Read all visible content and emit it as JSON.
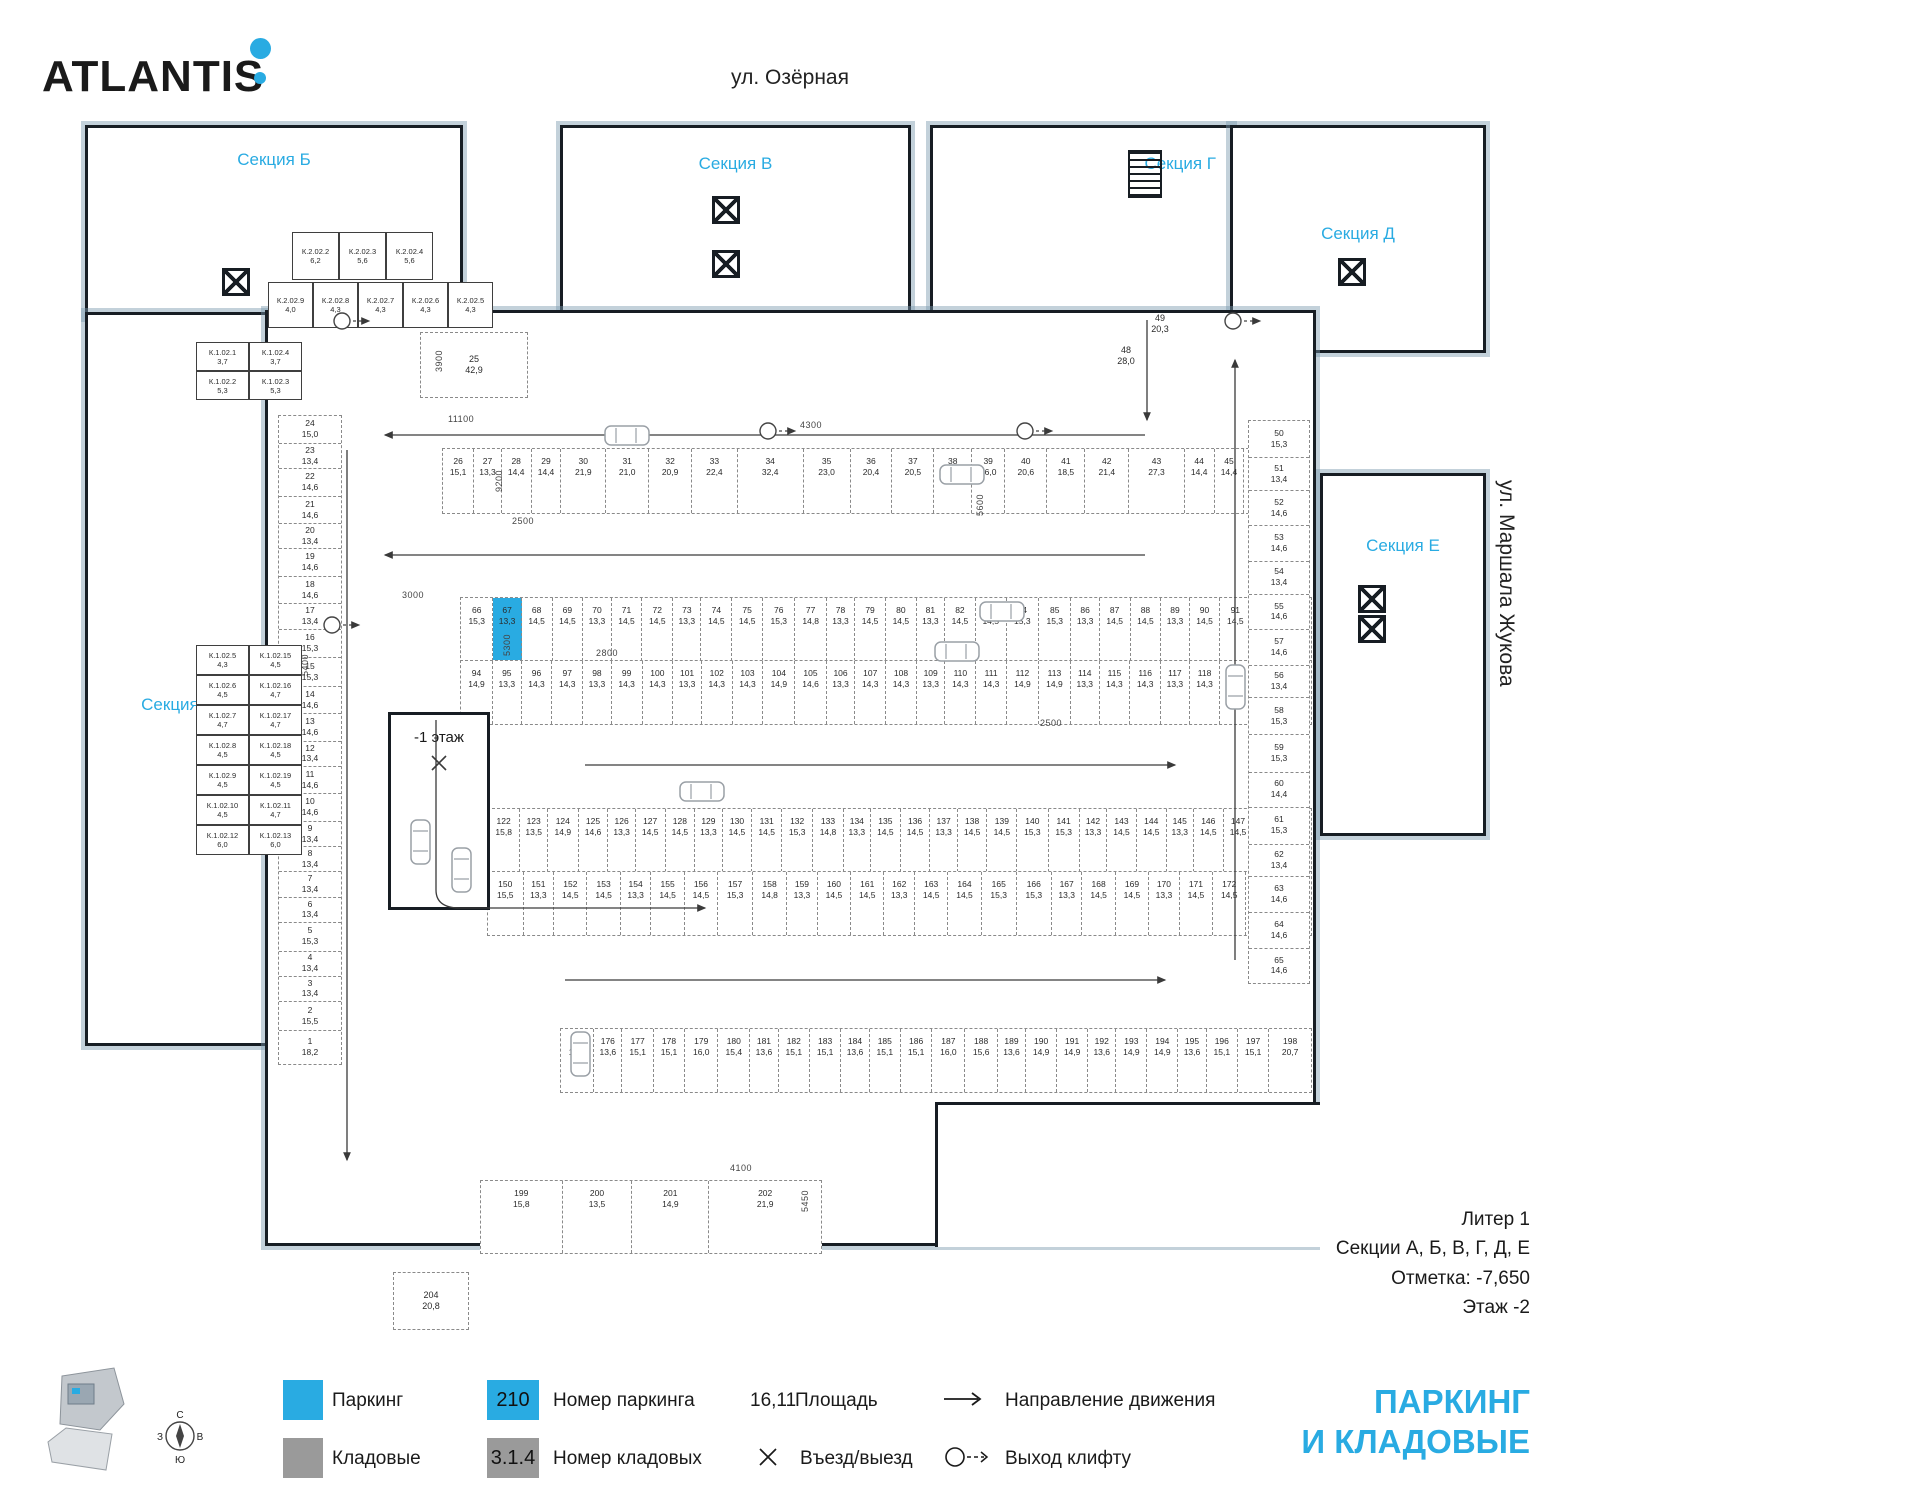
{
  "brand": {
    "logo_text": "ATLANTIS"
  },
  "streets": {
    "top": "ул. Озёрная",
    "right": "ул. Маршала Жукова"
  },
  "sections": {
    "a": "Секция А",
    "b": "Секция Б",
    "v": "Секция В",
    "g": "Секция Г",
    "d": "Секция Д",
    "e": "Секция Е"
  },
  "title_block": {
    "line1": "Литер 1",
    "line2": "Секции А, Б, В, Г, Д, Е",
    "line3": "Отметка:  -7,650",
    "line4": "Этаж  -2"
  },
  "poster_title": {
    "line1": "ПАРКИНГ",
    "line2": "И КЛАДОВЫЕ"
  },
  "legend": {
    "parking_label": "Паркинг",
    "parking_number_box": "210",
    "parking_number_label": "Номер паркинга",
    "area_value": "16,11",
    "area_label": "Площадь",
    "direction_label": "Направление движения",
    "storage_label": "Кладовые",
    "storage_number_box": "3.1.4",
    "storage_number_label": "Номер кладовых",
    "entry_label": "Въезд/выезд",
    "lift_label": "Выход клифту"
  },
  "colors": {
    "accent": "#29abe2",
    "storage_gray": "#9a9a9a",
    "wall": "#171d23",
    "perimeter": "#7a99ac"
  },
  "ramp": {
    "label": "-1 этаж"
  },
  "compass": {
    "n": "С",
    "s": "Ю",
    "e": "В",
    "w": "З"
  },
  "highlight_spot": "67",
  "rows": {
    "top": [
      [
        "26",
        "15,1"
      ],
      [
        "27",
        "13,3"
      ],
      [
        "28",
        "14,4"
      ],
      [
        "29",
        "14,4"
      ],
      [
        "30",
        "21,9"
      ],
      [
        "31",
        "21,0"
      ],
      [
        "32",
        "20,9"
      ],
      [
        "33",
        "22,4"
      ],
      [
        "34",
        "32,4"
      ],
      [
        "35",
        "23,0"
      ],
      [
        "36",
        "20,4"
      ],
      [
        "37",
        "20,5"
      ],
      [
        "38",
        "18,4"
      ],
      [
        "39",
        "16,0"
      ],
      [
        "40",
        "20,6"
      ],
      [
        "41",
        "18,5"
      ],
      [
        "42",
        "21,4"
      ],
      [
        "43",
        "27,3"
      ],
      [
        "44",
        "14,4"
      ],
      [
        "45",
        "14,4"
      ],
      [
        "46",
        "14,4"
      ],
      [
        "47",
        "14,4"
      ]
    ],
    "mid1": [
      [
        "66",
        "15,3"
      ],
      [
        "67",
        "13,3"
      ],
      [
        "68",
        "14,5"
      ],
      [
        "69",
        "14,5"
      ],
      [
        "70",
        "13,3"
      ],
      [
        "71",
        "14,5"
      ],
      [
        "72",
        "14,5"
      ],
      [
        "73",
        "13,3"
      ],
      [
        "74",
        "14,5"
      ],
      [
        "75",
        "14,5"
      ],
      [
        "76",
        "15,3"
      ],
      [
        "77",
        "14,8"
      ],
      [
        "78",
        "13,3"
      ],
      [
        "79",
        "14,5"
      ],
      [
        "80",
        "14,5"
      ],
      [
        "81",
        "13,3"
      ],
      [
        "82",
        "14,5"
      ],
      [
        "83",
        "14,5"
      ],
      [
        "84",
        "15,3"
      ],
      [
        "85",
        "15,3"
      ],
      [
        "86",
        "13,3"
      ],
      [
        "87",
        "14,5"
      ],
      [
        "88",
        "14,5"
      ],
      [
        "89",
        "13,3"
      ],
      [
        "90",
        "14,5"
      ],
      [
        "91",
        "14,5"
      ],
      [
        "92",
        "13,3"
      ],
      [
        "93",
        "15,3"
      ]
    ],
    "mid2": [
      [
        "94",
        "14,9"
      ],
      [
        "95",
        "13,3"
      ],
      [
        "96",
        "14,3"
      ],
      [
        "97",
        "14,3"
      ],
      [
        "98",
        "13,3"
      ],
      [
        "99",
        "14,3"
      ],
      [
        "100",
        "14,3"
      ],
      [
        "101",
        "13,3"
      ],
      [
        "102",
        "14,3"
      ],
      [
        "103",
        "14,3"
      ],
      [
        "104",
        "14,9"
      ],
      [
        "105",
        "14,6"
      ],
      [
        "106",
        "13,3"
      ],
      [
        "107",
        "14,3"
      ],
      [
        "108",
        "14,3"
      ],
      [
        "109",
        "13,3"
      ],
      [
        "110",
        "14,3"
      ],
      [
        "111",
        "14,3"
      ],
      [
        "112",
        "14,9"
      ],
      [
        "113",
        "14,9"
      ],
      [
        "114",
        "13,3"
      ],
      [
        "115",
        "14,3"
      ],
      [
        "116",
        "14,3"
      ],
      [
        "117",
        "13,3"
      ],
      [
        "118",
        "14,3"
      ],
      [
        "119",
        "14,3"
      ],
      [
        "120",
        "13,3"
      ],
      [
        "121",
        "14,9"
      ]
    ],
    "mid3": [
      [
        "122",
        "15,8"
      ],
      [
        "123",
        "13,5"
      ],
      [
        "124",
        "14,9"
      ],
      [
        "125",
        "14,6"
      ],
      [
        "126",
        "13,3"
      ],
      [
        "127",
        "14,5"
      ],
      [
        "128",
        "14,5"
      ],
      [
        "129",
        "13,3"
      ],
      [
        "130",
        "14,5"
      ],
      [
        "131",
        "14,5"
      ],
      [
        "132",
        "15,3"
      ],
      [
        "133",
        "14,8"
      ],
      [
        "134",
        "13,3"
      ],
      [
        "135",
        "14,5"
      ],
      [
        "136",
        "14,5"
      ],
      [
        "137",
        "13,3"
      ],
      [
        "138",
        "14,5"
      ],
      [
        "139",
        "14,5"
      ],
      [
        "140",
        "15,3"
      ],
      [
        "141",
        "15,3"
      ],
      [
        "142",
        "13,3"
      ],
      [
        "143",
        "14,5"
      ],
      [
        "144",
        "14,5"
      ],
      [
        "145",
        "13,3"
      ],
      [
        "146",
        "14,5"
      ],
      [
        "147",
        "14,5"
      ],
      [
        "148",
        "13,3"
      ],
      [
        "149",
        "15,3"
      ]
    ],
    "mid4": [
      [
        "150",
        "15,5"
      ],
      [
        "151",
        "13,3"
      ],
      [
        "152",
        "14,5"
      ],
      [
        "153",
        "14,5"
      ],
      [
        "154",
        "13,3"
      ],
      [
        "155",
        "14,5"
      ],
      [
        "156",
        "14,5"
      ],
      [
        "157",
        "15,3"
      ],
      [
        "158",
        "14,8"
      ],
      [
        "159",
        "13,3"
      ],
      [
        "160",
        "14,5"
      ],
      [
        "161",
        "14,5"
      ],
      [
        "162",
        "13,3"
      ],
      [
        "163",
        "14,5"
      ],
      [
        "164",
        "14,5"
      ],
      [
        "165",
        "15,3"
      ],
      [
        "166",
        "15,3"
      ],
      [
        "167",
        "13,3"
      ],
      [
        "168",
        "14,5"
      ],
      [
        "169",
        "14,5"
      ],
      [
        "170",
        "13,3"
      ],
      [
        "171",
        "14,5"
      ],
      [
        "172",
        "14,5"
      ],
      [
        "173",
        "13,3"
      ],
      [
        "174",
        "15,3"
      ]
    ],
    "bottom": [
      [
        "175",
        "16,0"
      ],
      [
        "176",
        "13,6"
      ],
      [
        "177",
        "15,1"
      ],
      [
        "178",
        "15,1"
      ],
      [
        "179",
        "16,0"
      ],
      [
        "180",
        "15,4"
      ],
      [
        "181",
        "13,6"
      ],
      [
        "182",
        "15,1"
      ],
      [
        "183",
        "15,1"
      ],
      [
        "184",
        "13,6"
      ],
      [
        "185",
        "15,1"
      ],
      [
        "186",
        "15,1"
      ],
      [
        "187",
        "16,0"
      ],
      [
        "188",
        "15,6"
      ],
      [
        "189",
        "13,6"
      ],
      [
        "190",
        "14,9"
      ],
      [
        "191",
        "14,9"
      ],
      [
        "192",
        "13,6"
      ],
      [
        "193",
        "14,9"
      ],
      [
        "194",
        "14,9"
      ],
      [
        "195",
        "13,6"
      ],
      [
        "196",
        "15,1"
      ],
      [
        "197",
        "15,1"
      ],
      [
        "198",
        "20,7"
      ]
    ],
    "small": [
      [
        "199",
        "15,8"
      ],
      [
        "200",
        "13,5"
      ],
      [
        "201",
        "14,9"
      ],
      [
        "202",
        "21,9"
      ]
    ]
  },
  "columns": {
    "left": [
      [
        "24",
        "15,0"
      ],
      [
        "23",
        "13,4"
      ],
      [
        "22",
        "14,6"
      ],
      [
        "21",
        "14,6"
      ],
      [
        "20",
        "13,4"
      ],
      [
        "19",
        "14,6"
      ],
      [
        "18",
        "14,6"
      ],
      [
        "17",
        "13,4"
      ],
      [
        "16",
        "15,3"
      ],
      [
        "15",
        "15,3"
      ],
      [
        "14",
        "14,6"
      ],
      [
        "13",
        "14,6"
      ],
      [
        "12",
        "13,4"
      ],
      [
        "11",
        "14,6"
      ],
      [
        "10",
        "14,6"
      ],
      [
        "9",
        "13,4"
      ],
      [
        "8",
        "13,4"
      ],
      [
        "7",
        "13,4"
      ],
      [
        "6",
        "13,4"
      ],
      [
        "5",
        "15,3"
      ],
      [
        "4",
        "13,4"
      ],
      [
        "3",
        "13,4"
      ],
      [
        "2",
        "15,5"
      ],
      [
        "1",
        "18,2"
      ]
    ],
    "right": [
      [
        "50",
        "15,3"
      ],
      [
        "51",
        "13,4"
      ],
      [
        "52",
        "14,6"
      ],
      [
        "53",
        "14,6"
      ],
      [
        "54",
        "13,4"
      ],
      [
        "55",
        "14,6"
      ],
      [
        "57",
        "14,6"
      ],
      [
        "56",
        "13,4"
      ],
      [
        "58",
        "15,3"
      ],
      [
        "59",
        "15,3"
      ],
      [
        "60",
        "14,4"
      ],
      [
        "61",
        "15,3"
      ],
      [
        "62",
        "13,4"
      ],
      [
        "63",
        "14,6"
      ],
      [
        "64",
        "14,6"
      ],
      [
        "65",
        "14,6"
      ]
    ]
  },
  "special_spots": {
    "s25": {
      "n": "25",
      "a": "42,9"
    },
    "s48": {
      "n": "48",
      "a": "28,0"
    },
    "s49": {
      "n": "49",
      "a": "20,3"
    },
    "s204": {
      "n": "204",
      "a": "20,8"
    }
  },
  "storages": {
    "top_row1": [
      [
        "К.2.02.2",
        "6,2"
      ],
      [
        "К.2.02.3",
        "5,6"
      ],
      [
        "К.2.02.4",
        "5,6"
      ]
    ],
    "top_row2": [
      [
        "К.2.02.9",
        "4,0"
      ],
      [
        "К.2.02.8",
        "4,3"
      ],
      [
        "К.2.02.7",
        "4,3"
      ],
      [
        "К.2.02.6",
        "4,3"
      ],
      [
        "К.2.02.5",
        "4,3"
      ]
    ],
    "left_top": [
      [
        "К.1.02.1",
        "3,7"
      ],
      [
        "К.1.02.4",
        "3,7"
      ],
      [
        "К.1.02.2",
        "5,3"
      ],
      [
        "К.1.02.3",
        "5,3"
      ]
    ],
    "left_mid": [
      [
        "К.1.02.5",
        "4,3"
      ],
      [
        "К.1.02.15",
        "4,5"
      ],
      [
        "К.1.02.6",
        "4,5"
      ],
      [
        "К.1.02.16",
        "4,7"
      ],
      [
        "К.1.02.7",
        "4,7"
      ],
      [
        "К.1.02.17",
        "4,7"
      ],
      [
        "К.1.02.8",
        "4,5"
      ],
      [
        "К.1.02.18",
        "4,5"
      ],
      [
        "К.1.02.9",
        "4,5"
      ],
      [
        "К.1.02.19",
        "4,5"
      ],
      [
        "К.1.02.10",
        "4,5"
      ],
      [
        "К.1.02.11",
        "4,7"
      ],
      [
        "К.1.02.12",
        "6,0"
      ],
      [
        "К.1.02.13",
        "6,0"
      ]
    ]
  },
  "dimensions": [
    "3900",
    "11100",
    "9200",
    "2500",
    "3000",
    "2800",
    "5400",
    "5600",
    "5300",
    "5450",
    "4100",
    "4300",
    "2500"
  ]
}
